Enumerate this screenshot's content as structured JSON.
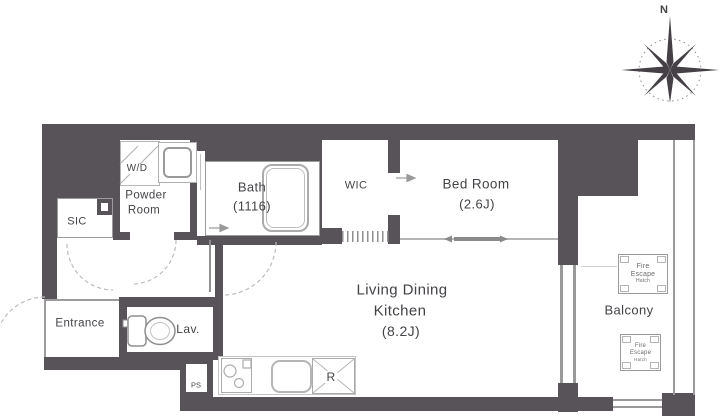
{
  "rooms": {
    "wd": "W/D",
    "powder1": "Powder",
    "powder2": "Room",
    "bath": "Bath",
    "bath_size": "(1116)",
    "wic": "WIC",
    "bedroom": "Bed Room",
    "bedroom_size": "(2.6J)",
    "sic": "SIC",
    "entrance": "Entrance",
    "lav": "Lav.",
    "ps": "PS",
    "ldk1": "Living Dining",
    "ldk2": "Kitchen",
    "ldk_size": "(8.2J)",
    "balcony": "Balcony",
    "fridge": "R"
  },
  "compass": {
    "north": "N"
  },
  "fire_escape": {
    "line1": "Fire",
    "line2": "Escape",
    "line3": "Hatch"
  },
  "colors": {
    "wall": "#585358",
    "line": "#9c9c9c",
    "text": "#454247"
  }
}
